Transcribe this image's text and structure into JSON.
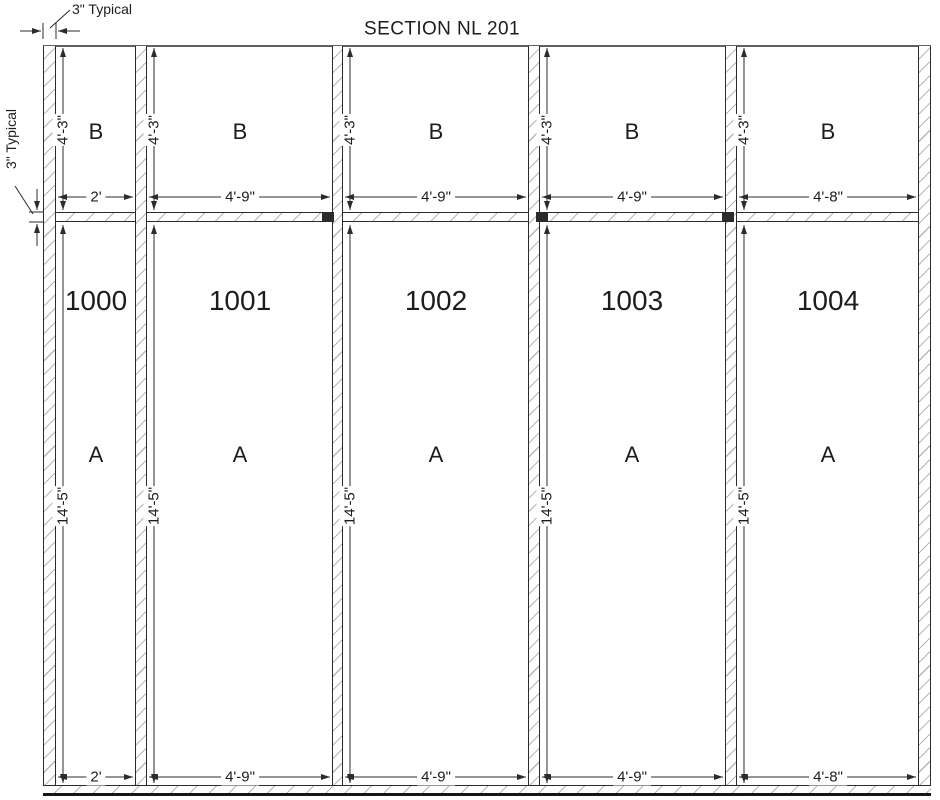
{
  "title": "SECTION NL 201",
  "annotations": {
    "wall_thickness": "3\" Typical",
    "slab_thickness": "3\" Typical"
  },
  "bays": [
    {
      "number": "1000",
      "region_top_label": "B",
      "region_bottom_label": "A",
      "top_height": "4'-3\"",
      "bottom_height": "14'-5\"",
      "top_width": "2'",
      "bottom_width": "2'"
    },
    {
      "number": "1001",
      "region_top_label": "B",
      "region_bottom_label": "A",
      "top_height": "4'-3\"",
      "bottom_height": "14'-5\"",
      "top_width": "4'-9\"",
      "bottom_width": "4'-9\""
    },
    {
      "number": "1002",
      "region_top_label": "B",
      "region_bottom_label": "A",
      "top_height": "4'-3\"",
      "bottom_height": "14'-5\"",
      "top_width": "4'-9\"",
      "bottom_width": "4'-9\""
    },
    {
      "number": "1003",
      "region_top_label": "B",
      "region_bottom_label": "A",
      "top_height": "4'-3\"",
      "bottom_height": "14'-5\"",
      "top_width": "4'-9\"",
      "bottom_width": "4'-9\""
    },
    {
      "number": "1004",
      "region_top_label": "B",
      "region_bottom_label": "A",
      "top_height": "4'-3\"",
      "bottom_height": "14'-5\"",
      "top_width": "4'-8\"",
      "bottom_width": "4'-8\""
    }
  ]
}
